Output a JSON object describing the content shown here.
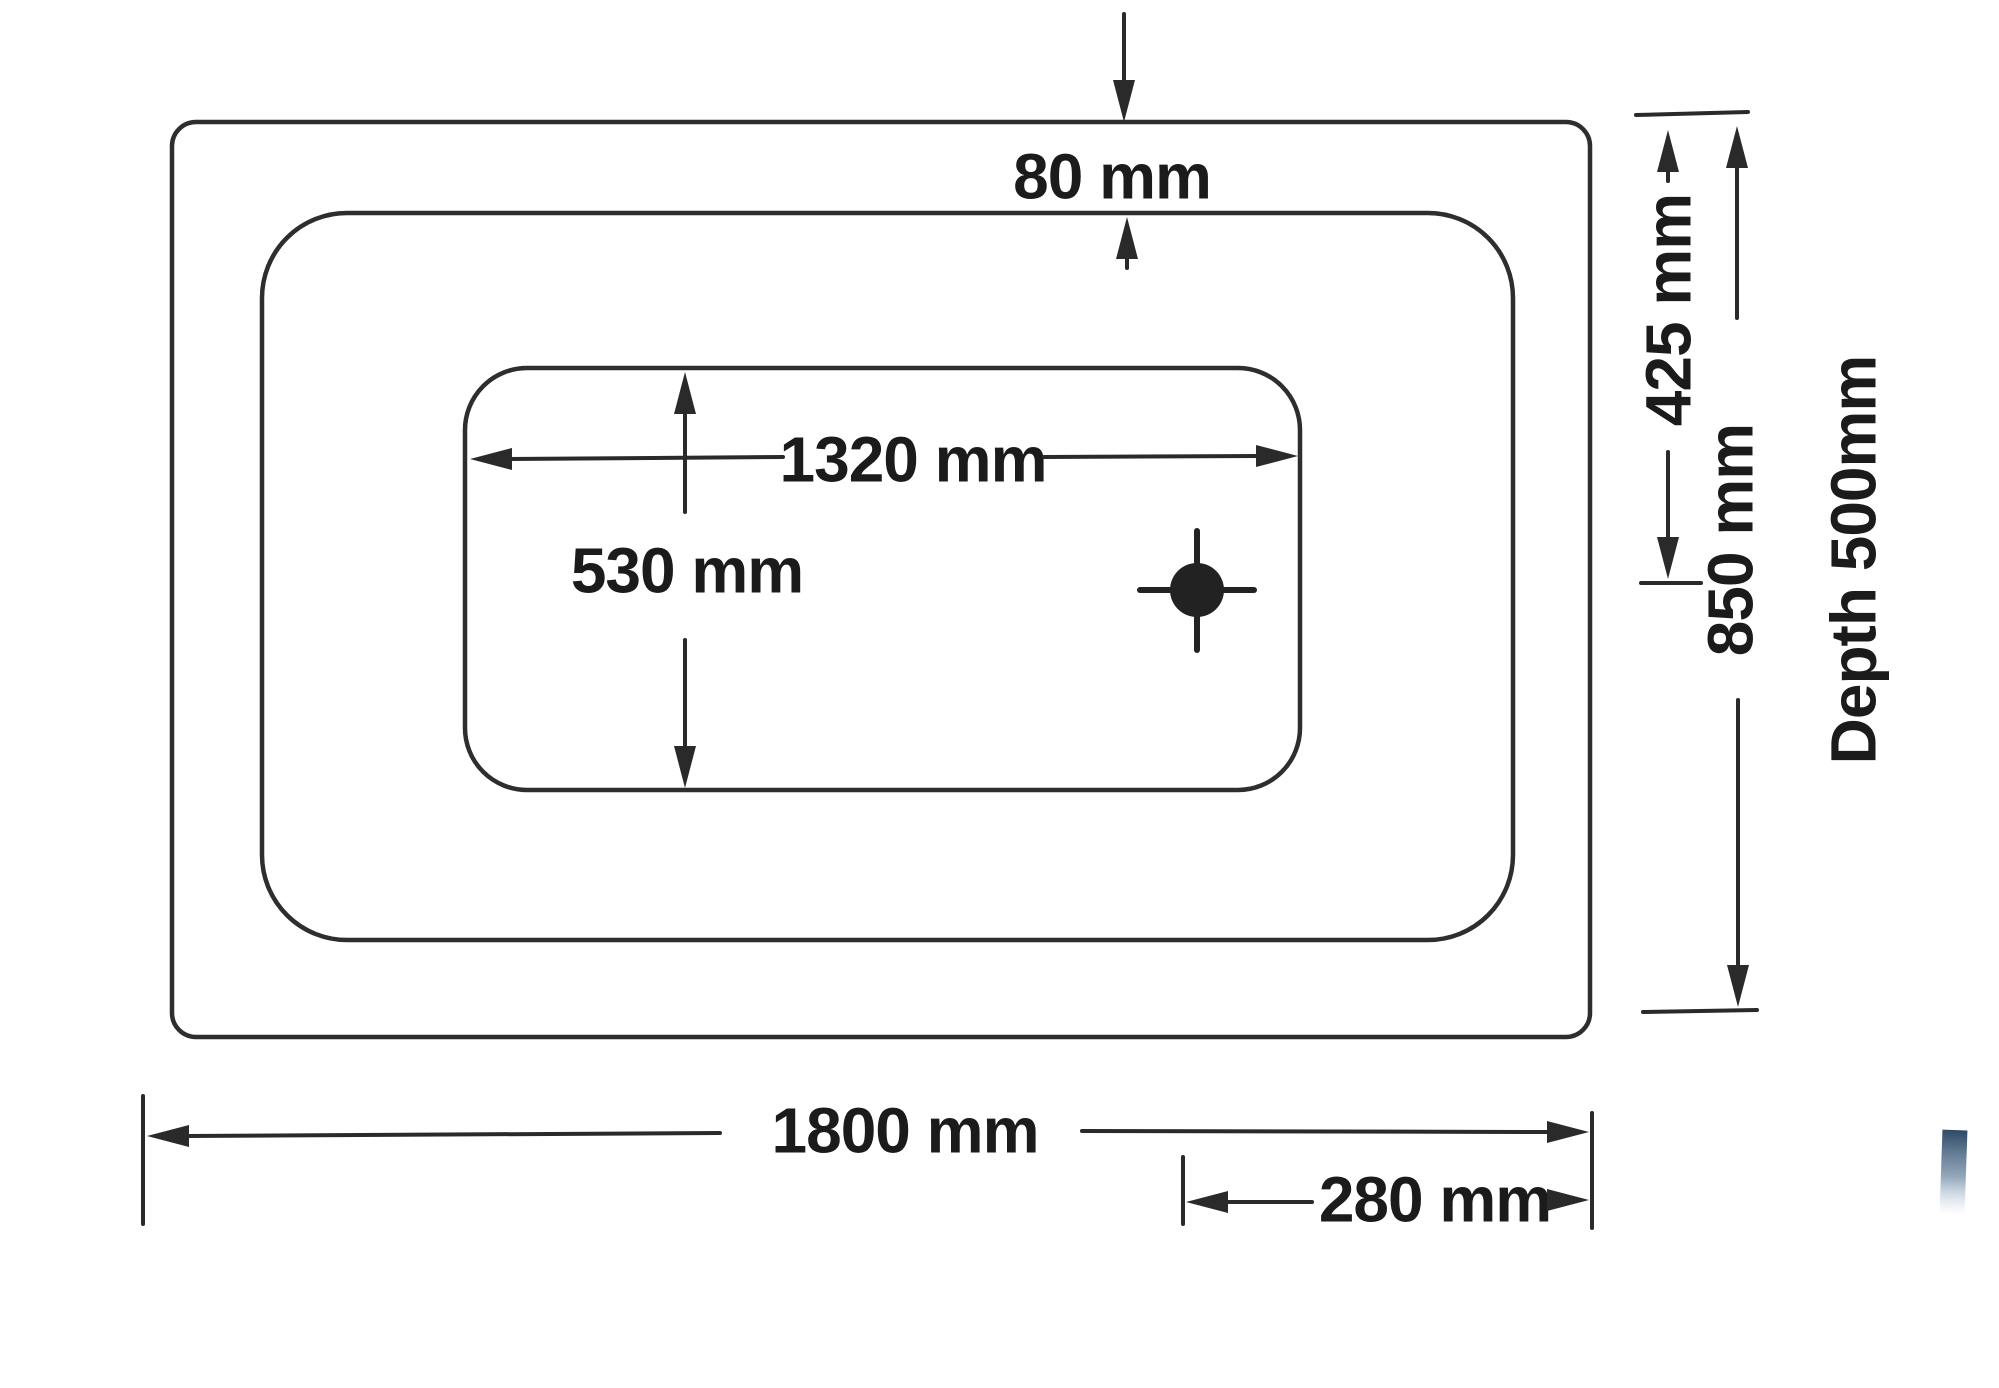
{
  "diagram": {
    "type": "technical-drawing",
    "subject": "bathtub-plan-view-with-dimensions",
    "dimensions": {
      "rim_width_top": "80 mm",
      "basin_length": "1320 mm",
      "basin_width": "530 mm",
      "edge_to_drain_center": "425 mm",
      "overall_width": "850 mm",
      "depth": "Depth 500mm",
      "overall_length": "1800 mm",
      "drain_to_edge": "280 mm"
    },
    "colors": {
      "line": "#2e2e2e",
      "text": "#1b1b1b",
      "background": "#ffffff",
      "ink_smudge": "#2e4a66"
    }
  }
}
